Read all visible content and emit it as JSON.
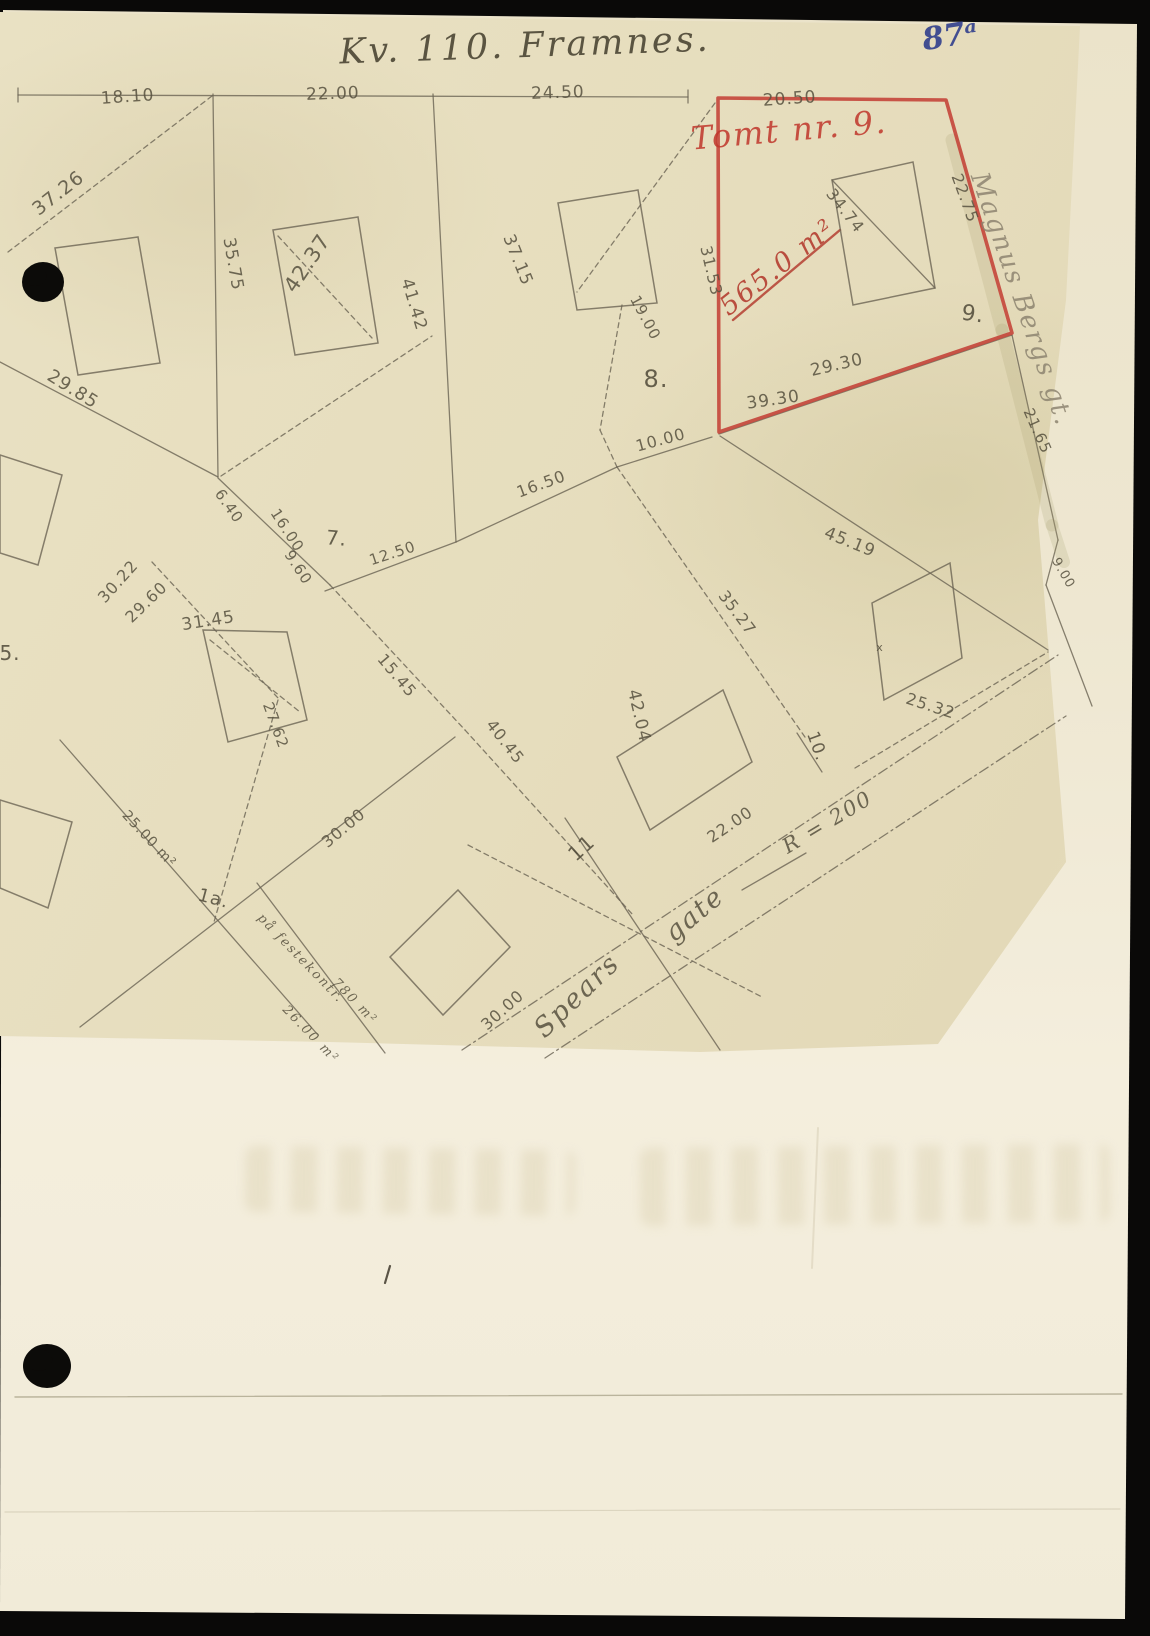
{
  "document": {
    "title": "Kv. 110. Framnes.",
    "page_number": "87ᵃ",
    "colors": {
      "paper_map": "#e6ddbd",
      "paper_page": "#f2ecd9",
      "pencil": "#57513f",
      "red_plot_line": "#c4453a",
      "red_text": "#c0362b",
      "blue_ink": "#35428e"
    }
  },
  "map": {
    "red_plot": {
      "title": "Tomt nr. 9.",
      "area_label": "565.0 m²",
      "polygon": "718,98 946,100 1012,333 719,432",
      "outline_color": "#c4453a"
    },
    "streets": [
      "Spears gate",
      "Magnus Bergs gt."
    ],
    "labels": [
      {
        "t": "18.10",
        "x": 128,
        "y": 102,
        "r": -4,
        "s": 17,
        "k": "measurement"
      },
      {
        "t": "22.00",
        "x": 333,
        "y": 99,
        "r": -2,
        "s": 17,
        "k": "measurement"
      },
      {
        "t": "24.50",
        "x": 558,
        "y": 98,
        "r": -2,
        "s": 17,
        "k": "measurement"
      },
      {
        "t": "20.50",
        "x": 790,
        "y": 104,
        "r": -4,
        "s": 17,
        "k": "measurement"
      },
      {
        "t": "37.26",
        "x": 62,
        "y": 198,
        "r": -38,
        "s": 19,
        "k": "measurement"
      },
      {
        "t": "35.75",
        "x": 228,
        "y": 265,
        "r": 80,
        "s": 17,
        "k": "measurement"
      },
      {
        "t": "42.37",
        "x": 313,
        "y": 267,
        "r": -56,
        "s": 21,
        "k": "measurement"
      },
      {
        "t": "37.15",
        "x": 513,
        "y": 262,
        "r": 68,
        "s": 17,
        "k": "measurement"
      },
      {
        "t": "41.42",
        "x": 409,
        "y": 306,
        "r": 73,
        "s": 17,
        "k": "measurement"
      },
      {
        "t": "19.00",
        "x": 641,
        "y": 320,
        "r": 62,
        "s": 15,
        "k": "measurement"
      },
      {
        "t": "22.75",
        "x": 960,
        "y": 200,
        "r": 70,
        "s": 16,
        "k": "measurement"
      },
      {
        "t": "31.53",
        "x": 706,
        "y": 272,
        "r": 77,
        "s": 16,
        "k": "measurement"
      },
      {
        "t": "34.74",
        "x": 841,
        "y": 214,
        "r": 52,
        "s": 16,
        "k": "measurement"
      },
      {
        "t": "29.30",
        "x": 838,
        "y": 370,
        "r": -13,
        "s": 17,
        "k": "measurement"
      },
      {
        "t": "39.30",
        "x": 774,
        "y": 405,
        "r": -8,
        "s": 17,
        "k": "measurement"
      },
      {
        "t": "10.00",
        "x": 662,
        "y": 445,
        "r": -15,
        "s": 16,
        "k": "measurement"
      },
      {
        "t": "16.50",
        "x": 543,
        "y": 489,
        "r": -20,
        "s": 16,
        "k": "measurement"
      },
      {
        "t": "12.50",
        "x": 394,
        "y": 558,
        "r": -18,
        "s": 15,
        "k": "measurement"
      },
      {
        "t": "29.85",
        "x": 70,
        "y": 394,
        "r": 32,
        "s": 18,
        "k": "measurement"
      },
      {
        "t": "6.40",
        "x": 225,
        "y": 509,
        "r": 55,
        "s": 15,
        "k": "measurement"
      },
      {
        "t": "16.00",
        "x": 283,
        "y": 533,
        "r": 57,
        "s": 15,
        "k": "measurement"
      },
      {
        "t": "9.60",
        "x": 294,
        "y": 570,
        "r": 57,
        "s": 15,
        "k": "measurement"
      },
      {
        "t": "30.22",
        "x": 122,
        "y": 585,
        "r": -48,
        "s": 16,
        "k": "measurement"
      },
      {
        "t": "29.60",
        "x": 150,
        "y": 606,
        "r": -44,
        "s": 16,
        "k": "measurement"
      },
      {
        "t": "31.45",
        "x": 209,
        "y": 626,
        "r": -9,
        "s": 17,
        "k": "measurement"
      },
      {
        "t": "27.62",
        "x": 271,
        "y": 727,
        "r": 70,
        "s": 15,
        "k": "measurement"
      },
      {
        "t": "15.45",
        "x": 393,
        "y": 679,
        "r": 50,
        "s": 16,
        "k": "measurement"
      },
      {
        "t": "40.45",
        "x": 501,
        "y": 745,
        "r": 52,
        "s": 16,
        "k": "measurement"
      },
      {
        "t": "42.04",
        "x": 634,
        "y": 717,
        "r": 77,
        "s": 17,
        "k": "measurement"
      },
      {
        "t": "35.27",
        "x": 733,
        "y": 616,
        "r": 53,
        "s": 16,
        "k": "measurement"
      },
      {
        "t": "45.19",
        "x": 848,
        "y": 547,
        "r": 22,
        "s": 17,
        "k": "measurement"
      },
      {
        "t": "25.32",
        "x": 929,
        "y": 711,
        "r": 18,
        "s": 16,
        "k": "measurement"
      },
      {
        "t": "22.00",
        "x": 733,
        "y": 829,
        "r": -34,
        "s": 16,
        "k": "measurement"
      },
      {
        "t": "30.00",
        "x": 347,
        "y": 832,
        "r": -40,
        "s": 16,
        "k": "measurement"
      },
      {
        "t": "30.00",
        "x": 506,
        "y": 1014,
        "r": -42,
        "s": 16,
        "k": "measurement"
      },
      {
        "t": "25.00 m²",
        "x": 146,
        "y": 842,
        "r": 47,
        "s": 14,
        "k": "measurement"
      },
      {
        "t": "21.65",
        "x": 1033,
        "y": 433,
        "r": 66,
        "s": 15,
        "k": "measurement"
      },
      {
        "t": "9.00",
        "x": 1060,
        "y": 575,
        "r": 60,
        "s": 13,
        "k": "measurement"
      },
      {
        "t": "x",
        "x": 880,
        "y": 651,
        "r": 0,
        "s": 11,
        "k": "measurement"
      },
      {
        "t": "7.",
        "x": 336,
        "y": 545,
        "r": 5,
        "s": 20,
        "k": "plot-number"
      },
      {
        "t": "8.",
        "x": 656,
        "y": 387,
        "r": 0,
        "s": 24,
        "k": "plot-number"
      },
      {
        "t": "9.",
        "x": 972,
        "y": 321,
        "r": 8,
        "s": 22,
        "k": "plot-number"
      },
      {
        "t": "10.",
        "x": 812,
        "y": 748,
        "r": 70,
        "s": 17,
        "k": "plot-number"
      },
      {
        "t": "11",
        "x": 586,
        "y": 853,
        "r": -42,
        "s": 20,
        "k": "plot-number"
      },
      {
        "t": "1a.",
        "x": 212,
        "y": 904,
        "r": 15,
        "s": 18,
        "k": "plot-number"
      },
      {
        "t": "5.",
        "x": 10,
        "y": 660,
        "r": 0,
        "s": 20,
        "k": "plot-number"
      },
      {
        "t": "Spears",
        "x": 583,
        "y": 1002,
        "r": -44,
        "s": 27,
        "k": "street-name"
      },
      {
        "t": "gate",
        "x": 700,
        "y": 921,
        "r": -40,
        "s": 27,
        "k": "street-name"
      },
      {
        "t": "R = 200",
        "x": 831,
        "y": 828,
        "r": -31,
        "s": 21,
        "k": "street-name"
      },
      {
        "t": "Magnus Bergs gt.",
        "x": 1014,
        "y": 302,
        "r": 71,
        "s": 26,
        "k": "street-name",
        "c": "#8d8470"
      },
      {
        "t": "på festekontr.",
        "x": 298,
        "y": 961,
        "r": 46,
        "s": 13,
        "k": "note"
      },
      {
        "t": "780 m²",
        "x": 352,
        "y": 1004,
        "r": 46,
        "s": 13,
        "k": "note"
      },
      {
        "t": "26.00 m²",
        "x": 308,
        "y": 1037,
        "r": 46,
        "s": 13,
        "k": "note"
      },
      {
        "t": "Tomt nr. 9.",
        "x": 790,
        "y": 141,
        "r": -5,
        "s": 32,
        "k": "plot-title",
        "c": "#c0362b"
      },
      {
        "t": "565.0 m²",
        "x": 783,
        "y": 274,
        "r": -38,
        "s": 27,
        "k": "area",
        "c": "#b23529"
      }
    ],
    "lines": [
      {
        "p": [
          18,
          95,
          688,
          97
        ]
      },
      {
        "p": [
          213,
          94,
          218,
          477
        ]
      },
      {
        "p": [
          433,
          94,
          456,
          542
        ]
      },
      {
        "p": [
          0,
          362,
          218,
          477
        ]
      },
      {
        "p": [
          212,
          96,
          8,
          252
        ],
        "d": 1
      },
      {
        "p": [
          715,
          103,
          577,
          292
        ],
        "d": 1
      },
      {
        "p": [
          622,
          305,
          600,
          430
        ],
        "d": 1
      },
      {
        "p": [
          600,
          430,
          617,
          467
        ],
        "d": 1
      },
      {
        "p": [
          456,
          542,
          617,
          467
        ]
      },
      {
        "p": [
          325,
          591,
          456,
          542
        ]
      },
      {
        "p": [
          617,
          467,
          712,
          437
        ]
      },
      {
        "p": [
          221,
          476,
          432,
          336
        ],
        "d": 1
      },
      {
        "p": [
          218,
          478,
          330,
          585
        ]
      },
      {
        "p": [
          330,
          585,
          465,
          730
        ],
        "d": 1
      },
      {
        "p": [
          465,
          730,
          633,
          915
        ],
        "d": 1
      },
      {
        "p": [
          60,
          740,
          318,
          1035
        ]
      },
      {
        "p": [
          455,
          737,
          80,
          1027
        ]
      },
      {
        "p": [
          257,
          883,
          385,
          1053
        ]
      },
      {
        "p": [
          565,
          818,
          720,
          1050
        ]
      },
      {
        "p": [
          468,
          845,
          762,
          997
        ],
        "d": 1
      },
      {
        "p": [
          462,
          1050,
          1058,
          655
        ],
        "n": "street-line",
        "sd": 1
      },
      {
        "p": [
          545,
          1058,
          1066,
          716
        ],
        "n": "street-line",
        "sd": 1
      },
      {
        "p": [
          617,
          467,
          807,
          740
        ],
        "d": 1
      },
      {
        "p": [
          797,
          733,
          822,
          772
        ]
      },
      {
        "p": [
          720,
          436,
          1048,
          650
        ]
      },
      {
        "p": [
          855,
          768,
          1048,
          652
        ],
        "d": 1
      },
      {
        "p": [
          1012,
          335,
          1058,
          540
        ]
      },
      {
        "p": [
          1058,
          540,
          1046,
          585
        ]
      },
      {
        "p": [
          1046,
          585,
          1092,
          706
        ]
      },
      {
        "p": [
          152,
          562,
          278,
          698
        ],
        "d": 1
      },
      {
        "p": [
          278,
          700,
          214,
          922
        ],
        "d": 1
      },
      {
        "p": [
          278,
          236,
          372,
          338
        ],
        "d": 1
      },
      {
        "p": [
          210,
          640,
          300,
          712
        ],
        "d": 1
      },
      {
        "p": [
          832,
          180,
          935,
          288
        ]
      },
      {
        "p": [
          719,
          434,
          1012,
          335
        ]
      },
      {
        "p": [
          733,
          320,
          840,
          230
        ],
        "c": "#b23529",
        "w": 2.4,
        "n": "area-underline"
      },
      {
        "p": [
          742,
          890,
          806,
          853
        ],
        "n": "street-line"
      },
      {
        "p": [
          18,
          88,
          18,
          102
        ]
      },
      {
        "p": [
          688,
          90,
          688,
          103
        ]
      },
      {
        "p": [
          952,
          140,
          1002,
          330
        ],
        "c": "#a89f6e",
        "w": 13,
        "o": 0.2,
        "n": "street-shading"
      },
      {
        "p": [
          1002,
          330,
          1052,
          525
        ],
        "c": "#a89f6e",
        "w": 13,
        "o": 0.2,
        "n": "street-shading"
      },
      {
        "p": [
          1052,
          525,
          1064,
          562
        ],
        "c": "#a89f6e",
        "w": 12,
        "o": 0.2,
        "n": "street-shading"
      },
      {
        "p": [
          15,
          1397,
          1122,
          1394
        ],
        "c": "#b5ae96",
        "w": 1.4,
        "o": 0.9,
        "n": "page-rule-line"
      },
      {
        "p": [
          5,
          1512,
          1120,
          1509
        ],
        "c": "#d9d2bc",
        "w": 1.2,
        "o": 0.9,
        "n": "page-rule-line"
      },
      {
        "p": [
          390,
          1266,
          385,
          1283
        ],
        "c": "#4a4436",
        "w": 2.2,
        "o": 0.9,
        "n": "pen-mark"
      },
      {
        "p": [
          818,
          1128,
          812,
          1268
        ],
        "c": "#ded6bf",
        "w": 2,
        "o": 0.7,
        "n": "page-crease"
      }
    ],
    "buildings": [
      {
        "pts": "55,248 138,237 160,363 78,375"
      },
      {
        "pts": "273,230 358,217 378,343 295,355"
      },
      {
        "pts": "558,203 638,190 657,303 577,310"
      },
      {
        "pts": "832,180 913,162 935,288 853,305"
      },
      {
        "pts": "617,757 723,690 752,762 650,830"
      },
      {
        "pts": "872,603 950,563 962,658 884,700"
      },
      {
        "pts": "390,957 458,890 510,947 443,1015"
      },
      {
        "pts": "0,455 62,475 38,565 0,553"
      },
      {
        "pts": "0,800 72,822 48,908 0,888"
      },
      {
        "pts": "203,630 287,632 307,720 228,742"
      }
    ],
    "punch_holes": [
      {
        "cx": 43,
        "cy": 282,
        "rx": 21,
        "ry": 20
      },
      {
        "cx": 47,
        "cy": 1366,
        "rx": 24,
        "ry": 22
      }
    ]
  }
}
